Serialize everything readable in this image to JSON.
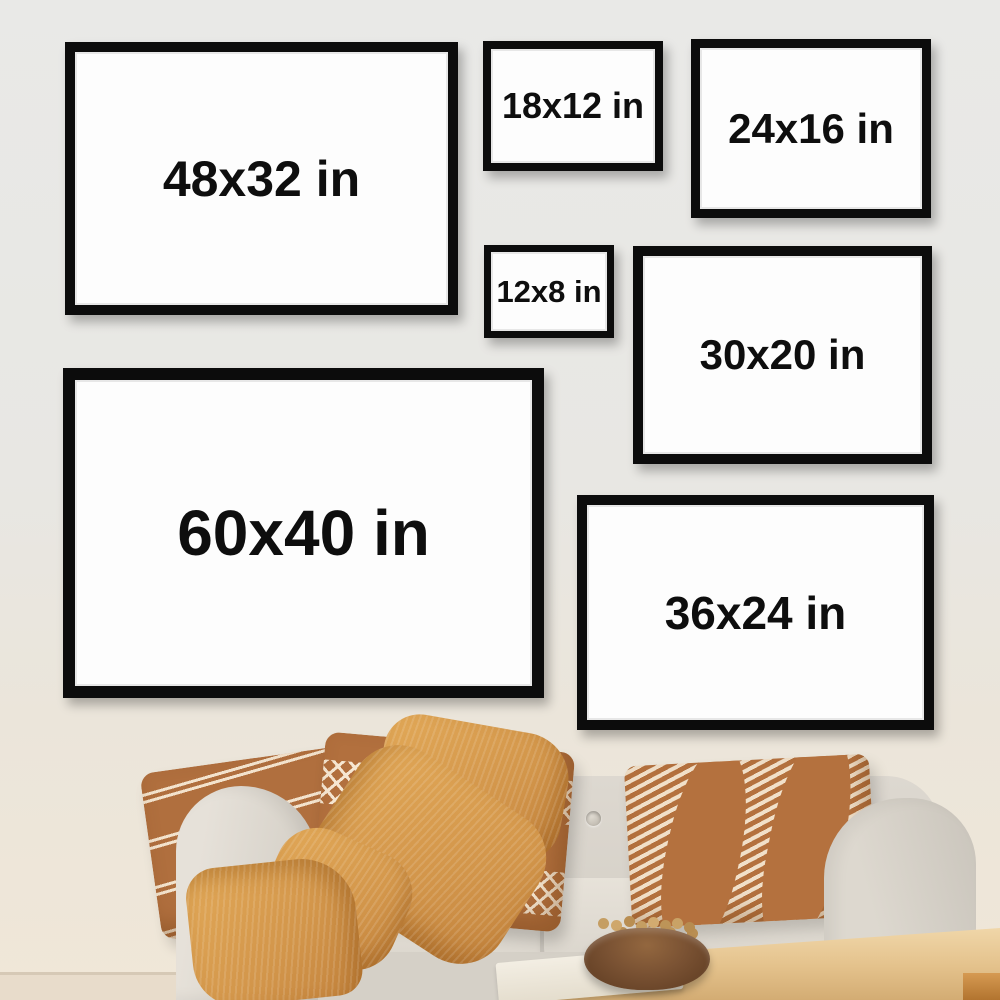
{
  "frames": [
    {
      "id": "48x32",
      "label": "48x32 in",
      "width_in": 48,
      "height_in": 32
    },
    {
      "id": "18x12",
      "label": "18x12 in",
      "width_in": 18,
      "height_in": 12
    },
    {
      "id": "24x16",
      "label": "24x16 in",
      "width_in": 24,
      "height_in": 16
    },
    {
      "id": "12x8",
      "label": "12x8 in",
      "width_in": 12,
      "height_in": 8
    },
    {
      "id": "30x20",
      "label": "30x20 in",
      "width_in": 30,
      "height_in": 20
    },
    {
      "id": "60x40",
      "label": "60x40 in",
      "width_in": 60,
      "height_in": 40
    },
    {
      "id": "36x24",
      "label": "36x24 in",
      "width_in": 36,
      "height_in": 24
    }
  ],
  "unit": "in",
  "colors": {
    "wall": "#e9e9e7",
    "frame_border": "#0c0c0c",
    "canvas_white": "#fdfdfd",
    "label_text": "#0e0e0e",
    "sofa_fabric": "#dcd7ce",
    "pillow_rust": "#b2703e",
    "pillow_pattern_cream": "#f3e3cd",
    "blanket_mustard": "#d99c4e",
    "table_wood": "#e6c292",
    "bowl_wood": "#7a5233",
    "floor": "#e8dccb"
  }
}
